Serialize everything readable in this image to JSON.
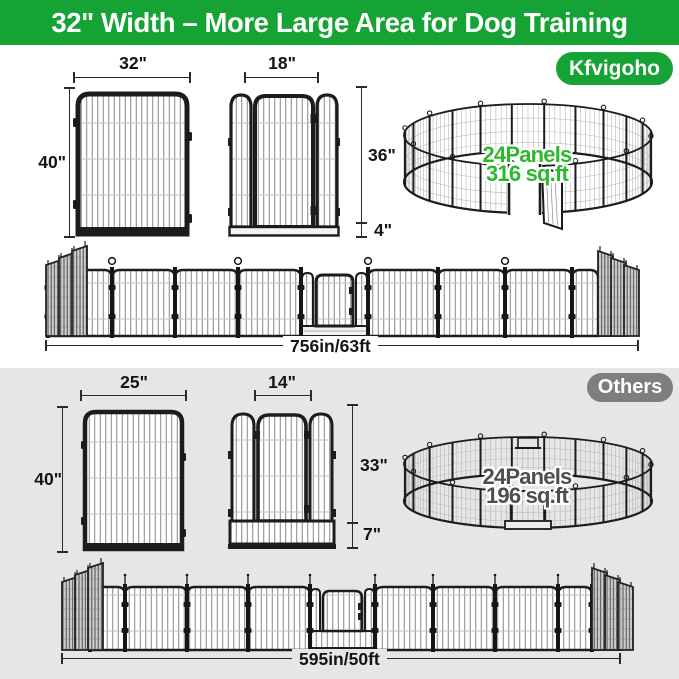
{
  "header": {
    "title": "32\" Width – More Large Area for Dog Training"
  },
  "kfvigoho": {
    "badge": "Kfvigoho",
    "panel": {
      "width": "32\"",
      "height": "40\""
    },
    "gate": {
      "width": "18\"",
      "height": "36\"",
      "bottom": "4\""
    },
    "pen": {
      "panels": "24Panels",
      "area": "316 sq.ft"
    },
    "row_length": "756in/63ft"
  },
  "others": {
    "badge": "Others",
    "panel": {
      "width": "25\"",
      "height": "40\""
    },
    "gate": {
      "width": "14\"",
      "height": "33\"",
      "bottom": "7\""
    },
    "pen": {
      "panels": "24Panels",
      "area": "196 sq.ft"
    },
    "row_length": "595in/50ft"
  },
  "colors": {
    "brand_green": "#16A335",
    "pen_text_green": "#2DB92D",
    "others_badge_gray": "#7E7E7E",
    "others_section_gray": "#E6E6E6",
    "pen_text_gray": "#4e4e4e"
  }
}
